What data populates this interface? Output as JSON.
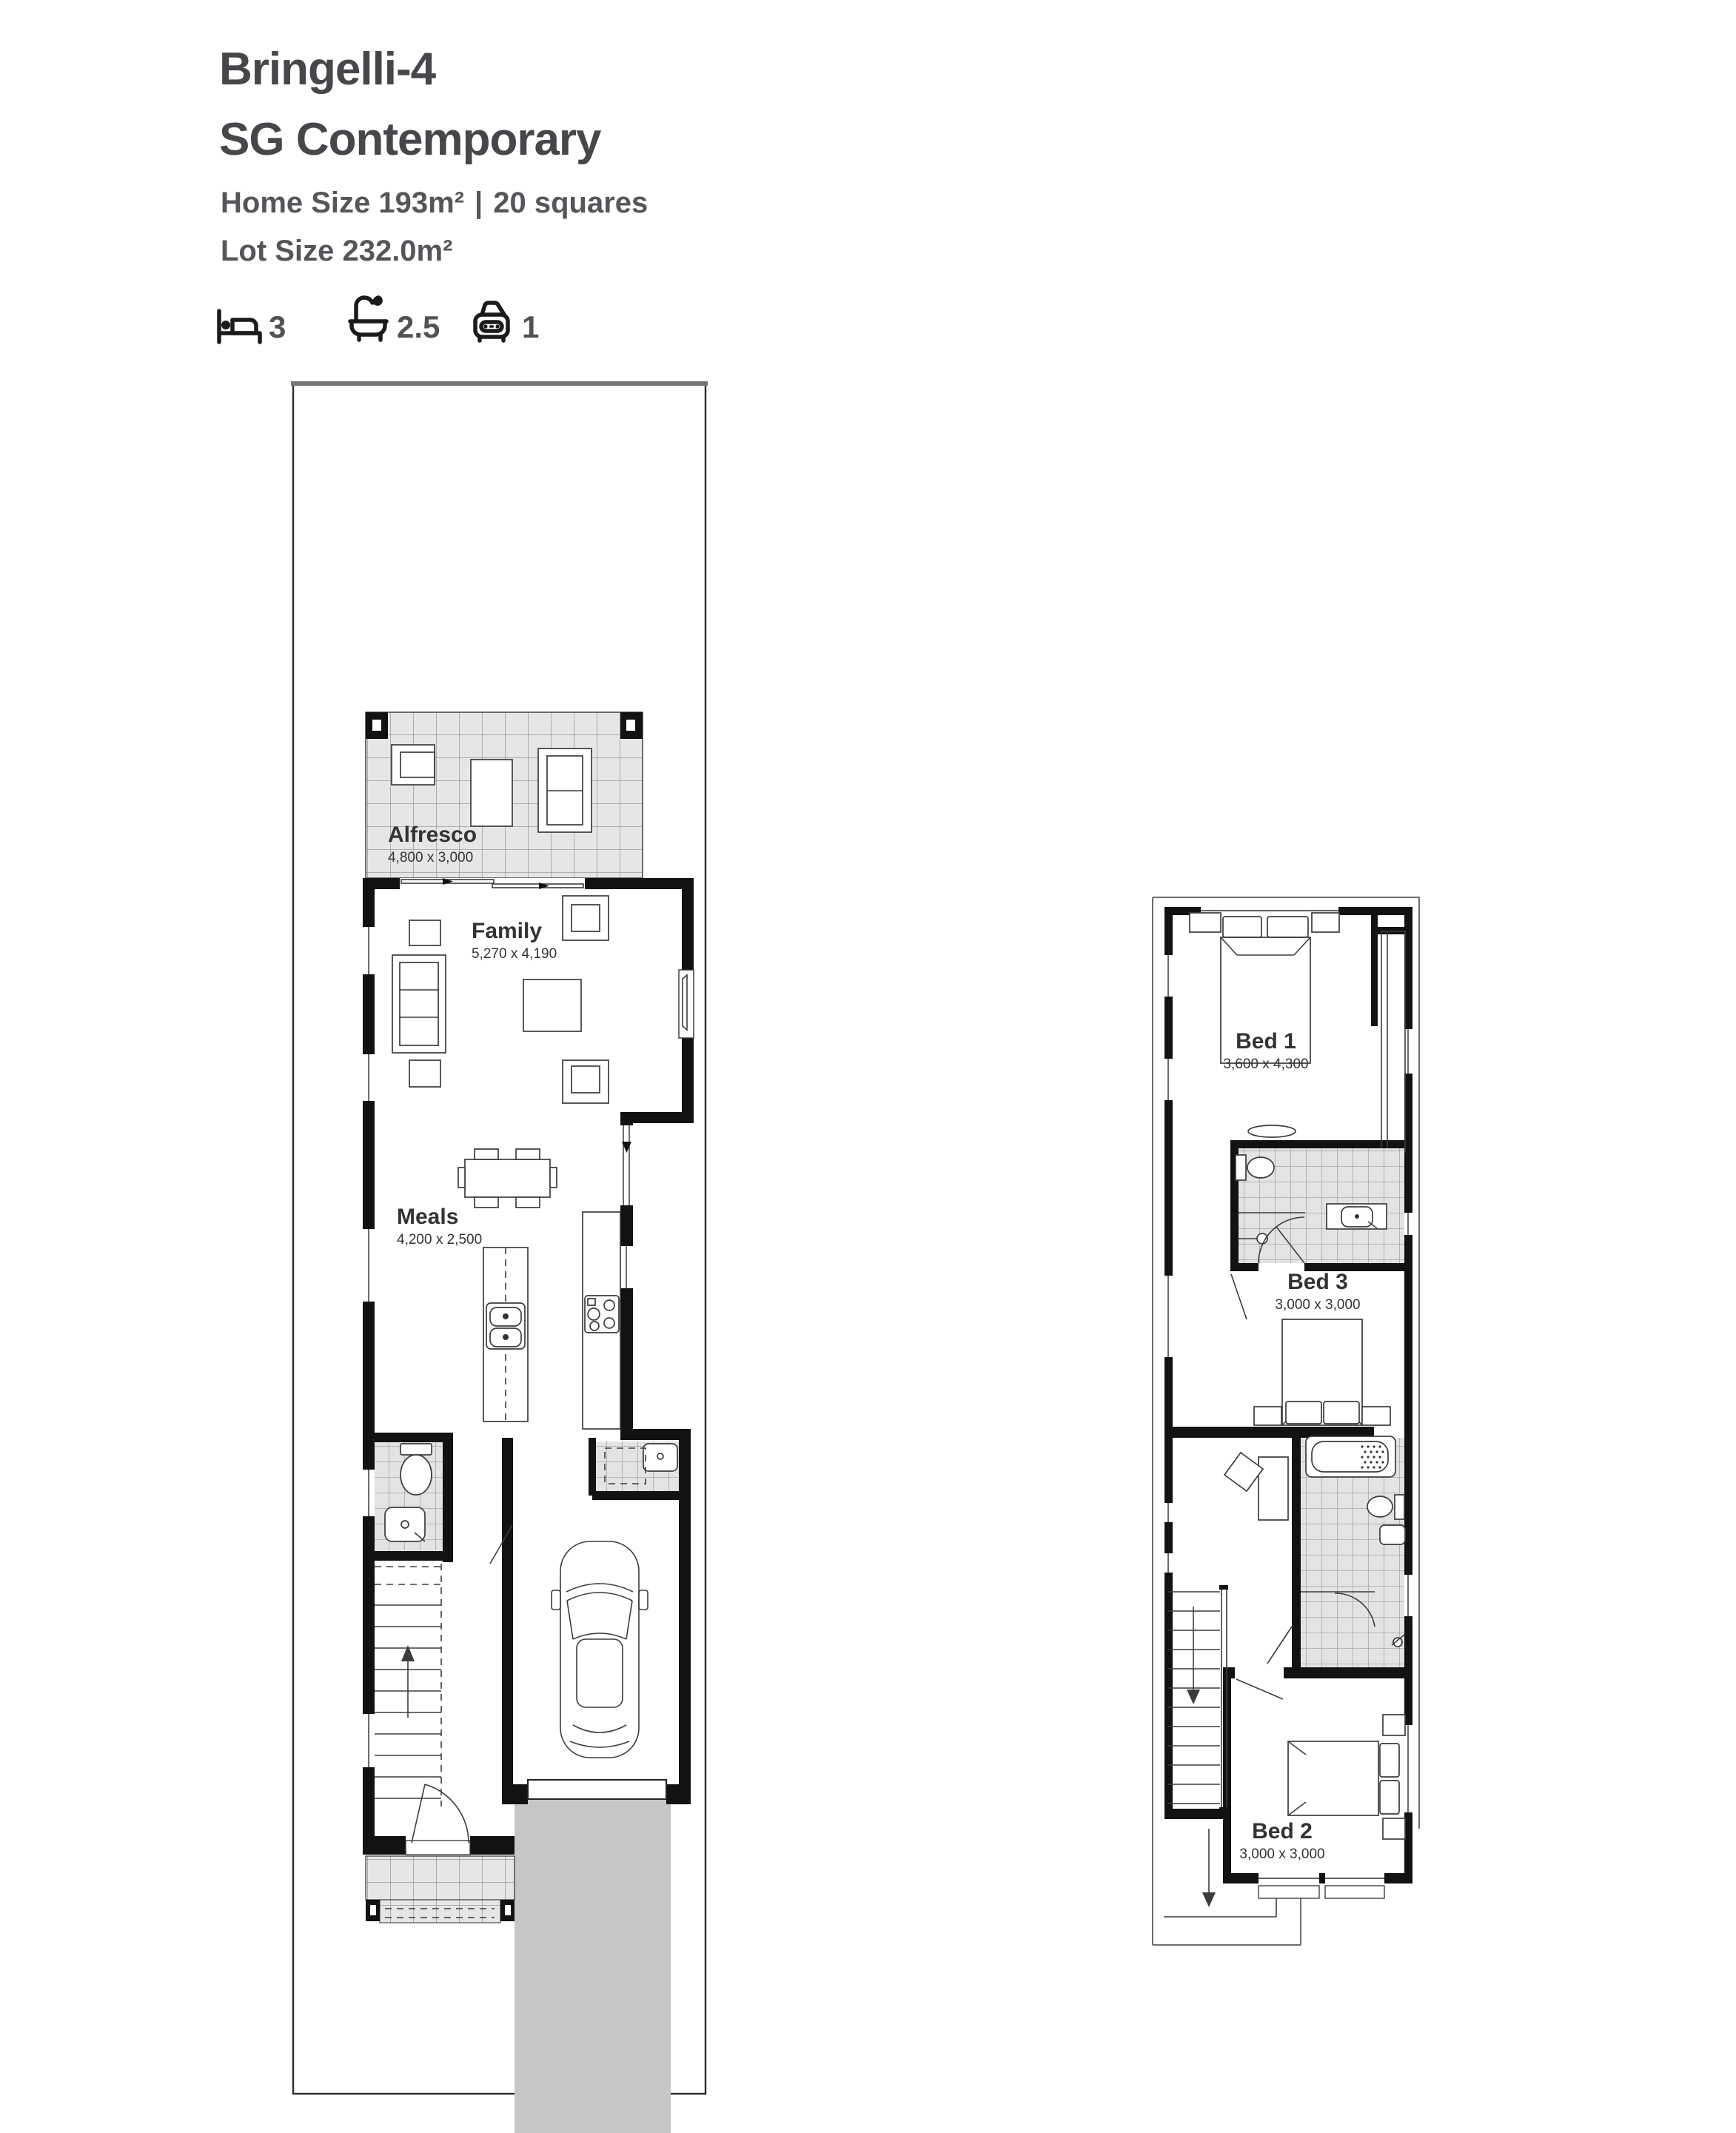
{
  "header": {
    "title": "Bringelli-4",
    "subtitle": "SG Contemporary",
    "home_size_label": "Home Size 193m²",
    "separator": "|",
    "squares_label": "20 squares",
    "lot_size_label": "Lot Size 232.0m²"
  },
  "stats": {
    "beds": {
      "icon": "bed-icon",
      "value": "3"
    },
    "baths": {
      "icon": "bath-icon",
      "value": "2.5"
    },
    "cars": {
      "icon": "car-icon",
      "value": "1"
    }
  },
  "ground_floor": {
    "rooms": [
      {
        "name": "Alfresco",
        "dims": "4,800 x 3,000"
      },
      {
        "name": "Family",
        "dims": "5,270 x 4,190"
      },
      {
        "name": "Meals",
        "dims": "4,200 x 2,500"
      }
    ]
  },
  "first_floor": {
    "rooms": [
      {
        "name": "Bed 1",
        "dims": "3,600 x 4,300"
      },
      {
        "name": "Bed 3",
        "dims": "3,000 x 3,000"
      },
      {
        "name": "Bed 2",
        "dims": "3,000 x 3,000"
      }
    ]
  },
  "colors": {
    "heading_text": "#46474a",
    "body_text": "#54565a",
    "wall": "#121212",
    "tile_fill": "#e6e6e6",
    "driveway": "#c6c6c8"
  }
}
